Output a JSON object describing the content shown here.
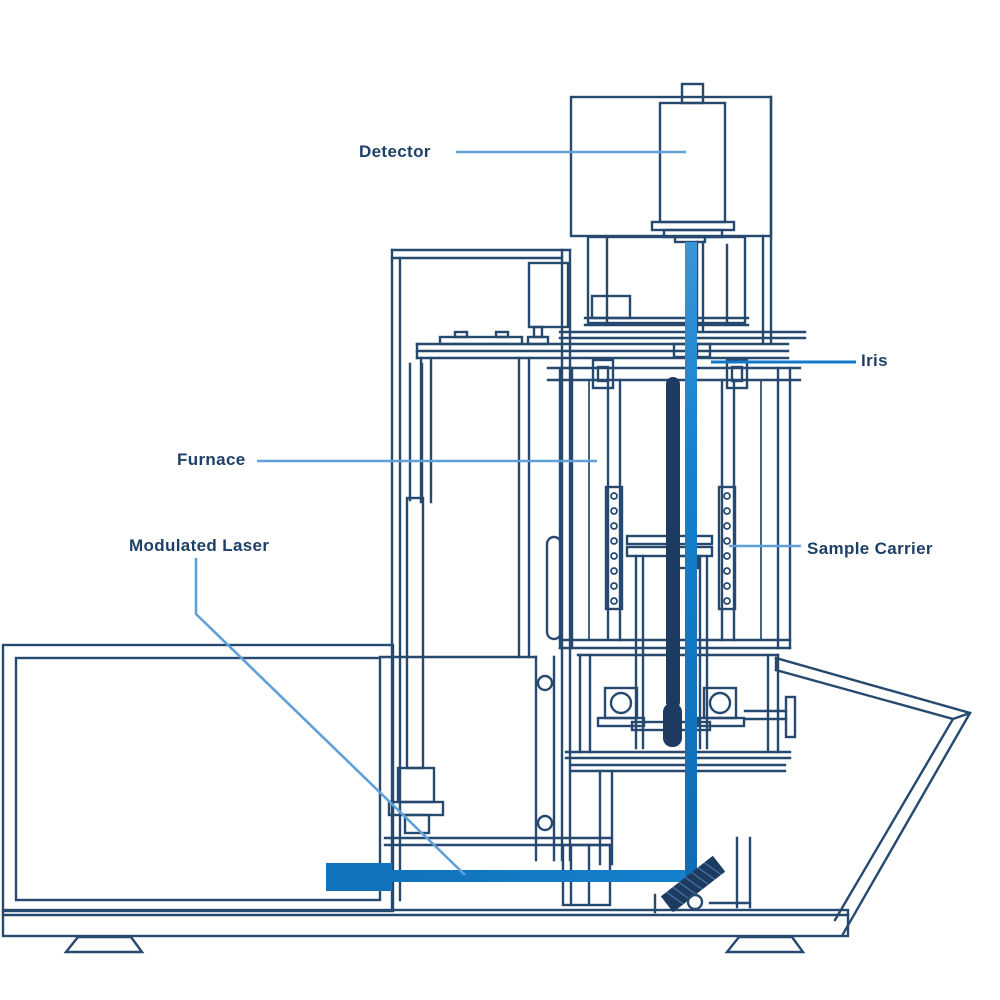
{
  "diagram": {
    "labels": {
      "detector": "Detector",
      "iris": "Iris",
      "furnace": "Furnace",
      "sample_carrier": "Sample Carrier",
      "modulated_laser": "Modulated Laser"
    }
  },
  "colors": {
    "outline": "#26496f",
    "outline-strong": "#1d3b60",
    "label-text": "#1e4066",
    "leader": "#5fa0d8",
    "leader-bright": "#1478c8",
    "beam": "#137cc8",
    "beam-light": "#3b95d6",
    "laser-box": "#1173bb",
    "background": "#ffffff"
  }
}
